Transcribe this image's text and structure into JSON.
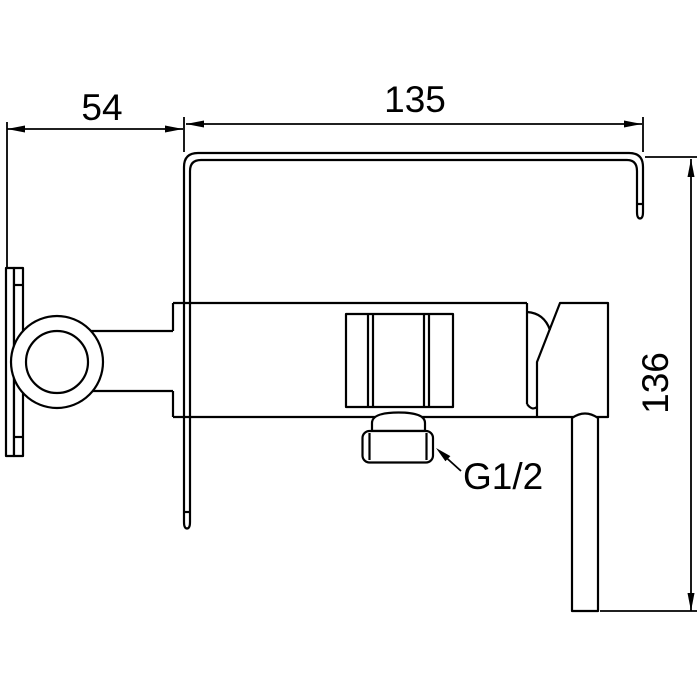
{
  "page": {
    "background": "#ffffff",
    "line_color": "#000000",
    "description": "Technical line drawing of a wall-mounted shower mixer, side view, with dimensions"
  },
  "annotations": {
    "dim_plate_depth": "54",
    "dim_body_width": "135",
    "dim_overall_height": "136",
    "thread_spec": "G1/2"
  }
}
